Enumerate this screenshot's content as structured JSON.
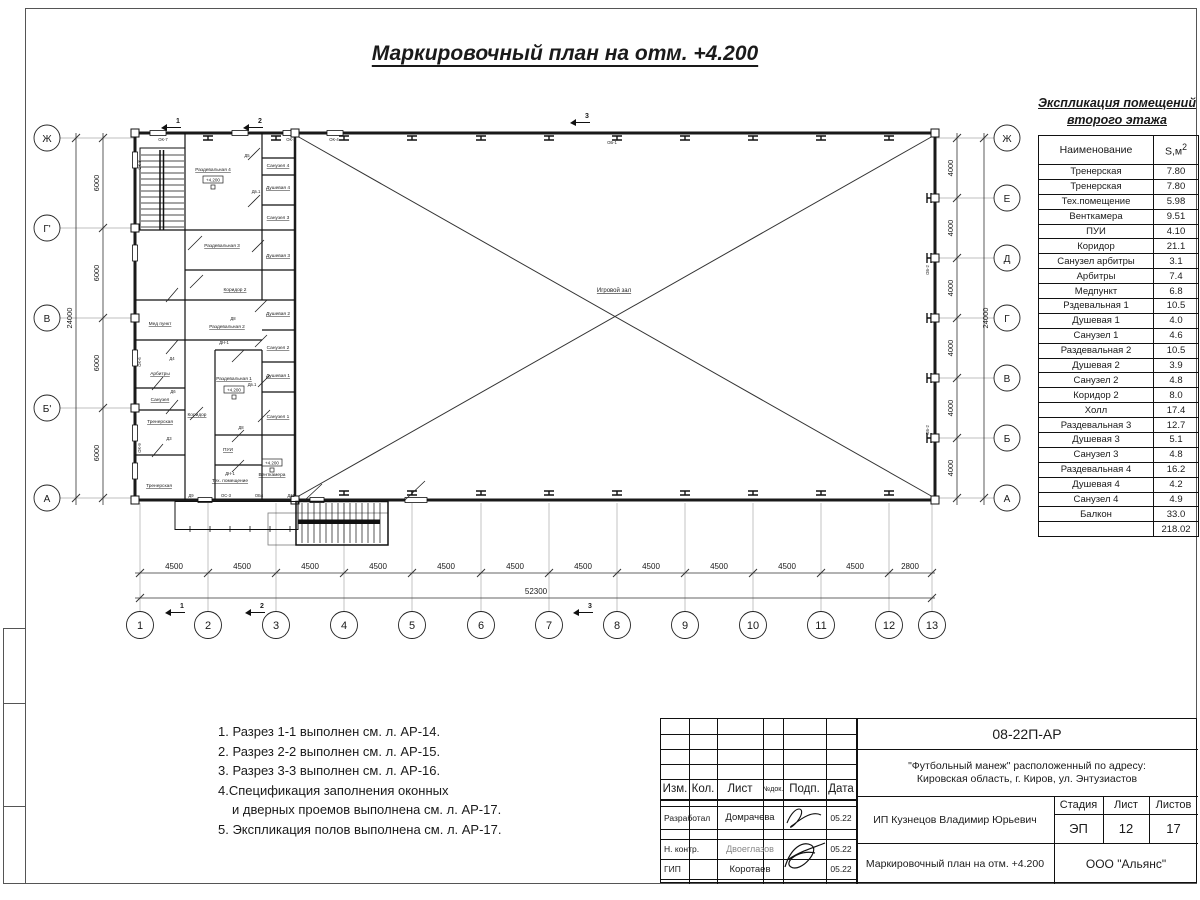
{
  "colors": {
    "ink": "#1a1a1a",
    "line_gray": "#999999",
    "paper": "#ffffff"
  },
  "sheet": {
    "title": "Маркировочный план на отм. +4.200",
    "notes": [
      "1. Разрез 1-1 выполнен см. л. АР-14.",
      "2. Разрез 2-2 выполнен см. л. АР-15.",
      "3. Разрез 3-3 выполнен см. л. АР-16.",
      "4.Спецификация заполнения оконных",
      "и дверных проемов выполнена см. л. АР-17.",
      "5. Экспликация полов выполнена см. л. АР-17."
    ]
  },
  "explication": {
    "title_line1": "Экспликация помещений",
    "title_line2": "второго этажа",
    "col_name": "Наименование",
    "col_area": "S,м",
    "col_area_sup": "2",
    "rows": [
      [
        "Тренерская",
        "7.80"
      ],
      [
        "Тренерская",
        "7.80"
      ],
      [
        "Тех.помещение",
        "5.98"
      ],
      [
        "Венткамера",
        "9.51"
      ],
      [
        "ПУИ",
        "4.10"
      ],
      [
        "Коридор",
        "21.1"
      ],
      [
        "Санузел арбитры",
        "3.1"
      ],
      [
        "Арбитры",
        "7.4"
      ],
      [
        "Медпункт",
        "6.8"
      ],
      [
        "Рздевальная 1",
        "10.5"
      ],
      [
        "Душевая 1",
        "4.0"
      ],
      [
        "Санузел 1",
        "4.6"
      ],
      [
        "Раздевальная 2",
        "10.5"
      ],
      [
        "Душевая 2",
        "3.9"
      ],
      [
        "Санузел 2",
        "4.8"
      ],
      [
        "Коридор 2",
        "8.0"
      ],
      [
        "Холл",
        "17.4"
      ],
      [
        "Раздевальная 3",
        "12.7"
      ],
      [
        "Душевая 3",
        "5.1"
      ],
      [
        "Санузел 3",
        "4.8"
      ],
      [
        "Раздевальная 4",
        "16.2"
      ],
      [
        "Душевая 4",
        "4.2"
      ],
      [
        "Санузел 4",
        "4.9"
      ],
      [
        "Балкон",
        "33.0"
      ]
    ],
    "total": "218.02"
  },
  "plan": {
    "hall_label": "Игровой зал",
    "elevation": "+4.200",
    "rooms": [
      "Раздевальная 4",
      "Санузел 4",
      "Душевая 4",
      "Раздевальная 3",
      "Санузел 3",
      "Душевая 3",
      "Коридор 2",
      "Мед пункт",
      "Раздевальная 2",
      "Душевая 2",
      "Санузел 2",
      "Арбитры",
      "Санузел",
      "Раздевальная 1",
      "Душевая 1",
      "Санузел 1",
      "Тренерская",
      "Коридор",
      "ПУИ",
      "Тех. помещение",
      "Венткамера",
      "Тренерская"
    ],
    "marks": [
      "ОК-7",
      "ОК-3",
      "ОК-4",
      "ОК-8",
      "ОК-6",
      "ОК-9",
      "Д9",
      "ОС-3",
      "ОБ4",
      "Д11",
      "ОБ-1",
      "ОБ-2",
      "ОБ-2"
    ],
    "door_codes": [
      "Д5",
      "Дв.1",
      "Д8",
      "ДН-1",
      "Д4",
      "Д6",
      "Д3",
      "Дв.1",
      "Д8",
      "ДН-1"
    ],
    "sections": [
      "1",
      "2",
      "3"
    ],
    "axes_bottom": {
      "labels": [
        "1",
        "2",
        "3",
        "4",
        "5",
        "6",
        "7",
        "8",
        "9",
        "10",
        "11",
        "12",
        "13"
      ]
    },
    "axes_left": {
      "labels": [
        "Ж",
        "Г'",
        "В",
        "Б'",
        "А"
      ]
    },
    "axes_right": {
      "labels": [
        "Ж",
        "Е",
        "Д",
        "Г",
        "В",
        "Б",
        "А"
      ]
    },
    "dims_bottom": {
      "spans": [
        "4500",
        "4500",
        "4500",
        "4500",
        "4500",
        "4500",
        "4500",
        "4500",
        "4500",
        "4500",
        "4500",
        "2800"
      ],
      "total": "52300"
    },
    "dims_left": {
      "spans": [
        "6000",
        "6000",
        "6000",
        "6000"
      ],
      "total": "24000"
    },
    "dims_right": {
      "spans": [
        "4000",
        "4000",
        "4000",
        "4000",
        "4000",
        "4000"
      ],
      "total": "24000"
    }
  },
  "titleblock": {
    "doc_number": "08-22П-АР",
    "address_line1": "\"Футбольный манеж\" расположенный по адресу:",
    "address_line2": "Кировская область, г. Киров, ул. Энтузиастов",
    "cols": [
      "Изм.",
      "Кол.",
      "Лист",
      "№док.",
      "Подп.",
      "Дата"
    ],
    "rows": [
      {
        "role": "Разработал",
        "name": "Домрачева",
        "date": "05.22"
      },
      {
        "role": "Н. контр.",
        "name": "Двоеглазов",
        "date": "05.22"
      },
      {
        "role": "ГИП",
        "name": "Коротаев",
        "date": "05.22"
      }
    ],
    "client": "ИП Кузнецов Владимир Юрьевич",
    "stage_label": "Стадия",
    "sheet_label": "Лист",
    "sheets_label": "Листов",
    "stage": "ЭП",
    "sheet": "12",
    "sheets": "17",
    "drawing_title": "Маркировочный план на отм. +4.200",
    "company": "ООО \"Альянс\""
  }
}
